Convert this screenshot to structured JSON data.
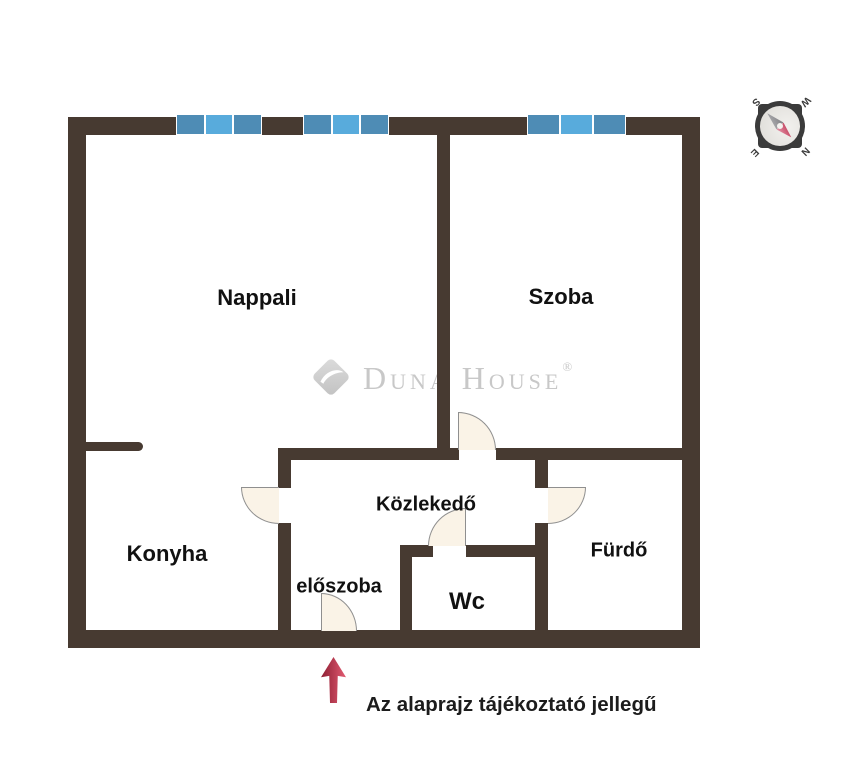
{
  "colors": {
    "wall": "#473a31",
    "window-dark": "#4e8cb5",
    "window-light": "#58abdc",
    "door-fill": "#faf3e7",
    "door-stroke": "#8f8f8f",
    "arrow-start": "#8e1f33",
    "arrow-end": "#e25b72",
    "watermark": "#c8c8c8",
    "label": "#111111"
  },
  "rooms": {
    "nappali": "Nappali",
    "szoba": "Szoba",
    "konyha": "Konyha",
    "kozlekedo": "Közlekedő",
    "eloszoba": "előszoba",
    "wc": "Wc",
    "furdo": "Fürdő"
  },
  "watermark": {
    "brand": "Duna House",
    "registered": "®"
  },
  "compass": {
    "north": "N",
    "south": "S",
    "east": "E",
    "west": "W"
  },
  "disclaimer": "Az alaprajz tájékoztató jellegű"
}
